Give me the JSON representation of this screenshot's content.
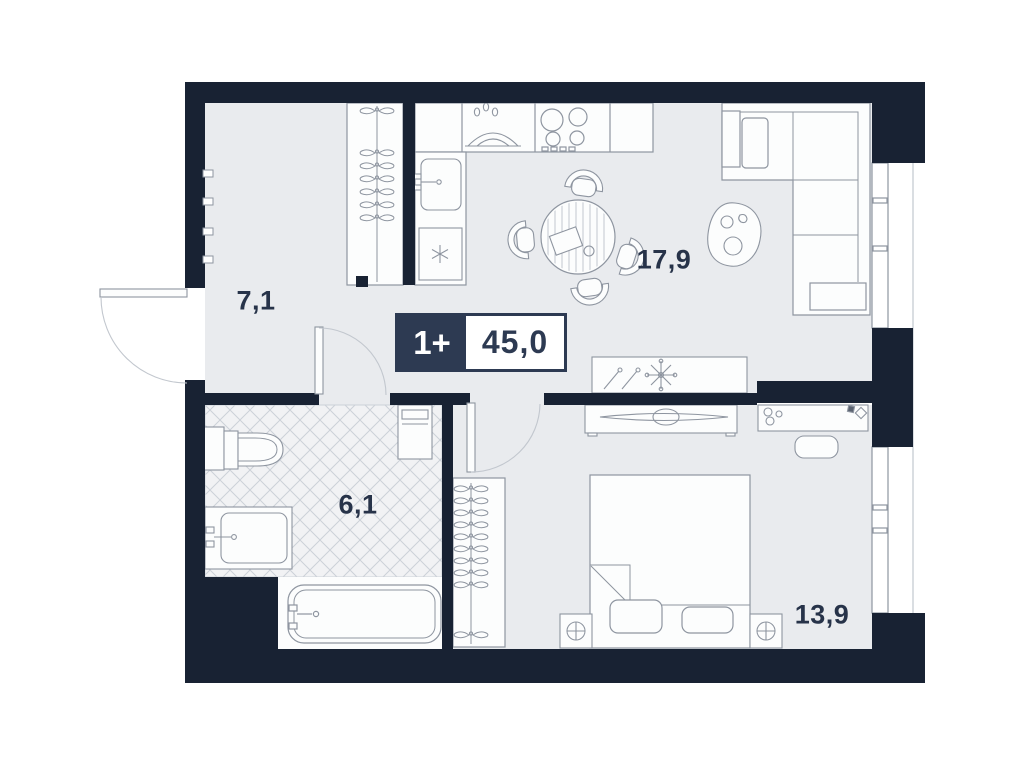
{
  "badge": {
    "rooms": "1+",
    "area": "45,0"
  },
  "rooms": [
    {
      "key": "hallway",
      "area": "7,1"
    },
    {
      "key": "kitchen-living",
      "area": "17,9"
    },
    {
      "key": "bathroom",
      "area": "6,1"
    },
    {
      "key": "bedroom",
      "area": "13,9"
    }
  ],
  "colors": {
    "wall": "#182233",
    "floor": "#e9ebee",
    "tile": "#f1f2f4",
    "tile_line": "#ccd1d8",
    "line": "#8e95a0",
    "soft_line": "#c2c7ce",
    "fixture": "#fcfdfd",
    "text": "#273349",
    "badge": "#2d3a52"
  }
}
